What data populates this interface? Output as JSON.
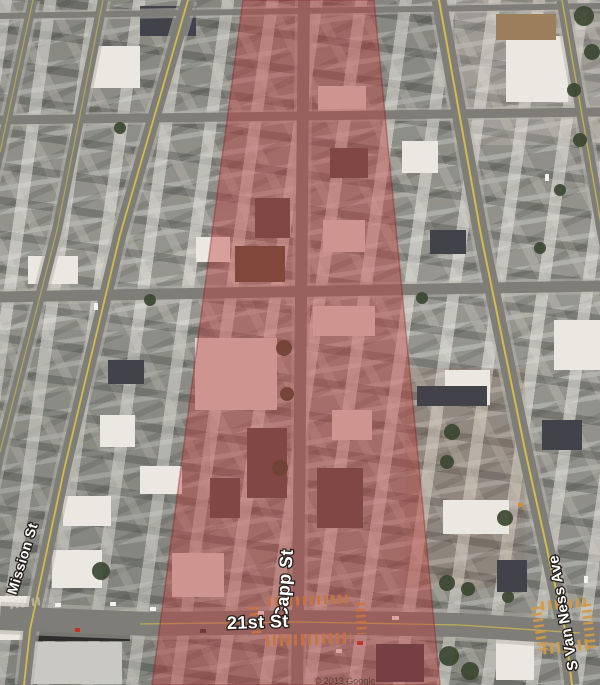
{
  "view": {
    "type": "aerial-satellite-view",
    "attribution": "© 2013 Google"
  },
  "streets": {
    "mission": "Mission St",
    "capp": "Capp St",
    "twenty_first": "21st St",
    "s_van_ness": "S Van Ness Ave"
  },
  "overlay": {
    "label": "highlighted-corridor",
    "color": "#be3c3c",
    "opacity": "0.42",
    "edge_color": "rgba(130,20,20,0.35)"
  },
  "palette": {
    "road": "#7e7d77",
    "sidewalk": "#b6b5ab",
    "center_line_yellow": "#d2bc4e",
    "crosswalk": "#d09a44",
    "tree": "#3b4731",
    "label_text": "#ffffff",
    "label_outline": "#26201c"
  }
}
